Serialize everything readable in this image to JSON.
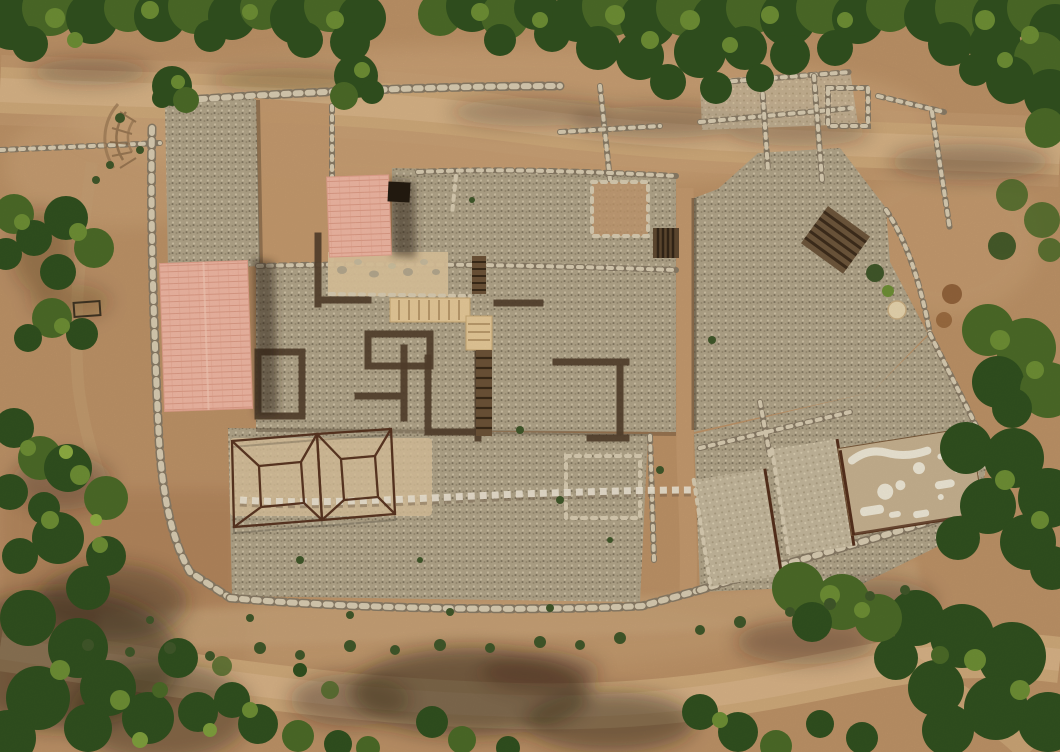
{
  "meta": {
    "title": "Aerial view of archaeological excavation site",
    "description": "Vertical aerial photograph of an excavated ancient settlement: gravel-covered platforms with stone wall foundations, two salmon-pink protective tile roofs, a rust-colored metal wireframe reconstruction, wooden walkway, stairways, a white plastered floor area, surrounded by dirt roads, scrub rows and dark green tree canopy."
  },
  "palette": {
    "dirt_base": "#bd9267",
    "dirt_light": "#d7b287",
    "dirt_red": "#a97a50",
    "road": "#cfa97a",
    "road_core": "#dcb98e",
    "gravel": "#b2a58a",
    "gravel_light": "#c4b79c",
    "sand": "#dcc49c",
    "stone_light": "#d9cdb2",
    "stone_dark": "#8a7c66",
    "trench": "#54402c",
    "rust": "#55301c",
    "wood": "#e6c998",
    "wood_line": "#ad8d5f",
    "roof_pink": "#f0b7a3",
    "roof_tile": "#de9c86",
    "tree_shade": "#22391a",
    "tree_dark": "#31511f",
    "tree_mid": "#4c6b28",
    "tree_light": "#6e8f35",
    "bush": "#41582a",
    "shadow": "#2e2114",
    "mosaic_white": "#efe8d6",
    "disc": "#e7d5ae"
  },
  "scene": {
    "type": "aerial-photo",
    "subject": "archaeological excavation",
    "features": [
      {
        "id": "tree-canopy-top",
        "label": "tree canopy band along top edge"
      },
      {
        "id": "dirt-road-top",
        "label": "dirt road below tree line"
      },
      {
        "id": "terrace-walls",
        "label": "rubble stone terrace walls"
      },
      {
        "id": "gravel-platforms",
        "label": "gravel-covered excavation platforms"
      },
      {
        "id": "protective-roof-large",
        "label": "large pink tiled protective roof"
      },
      {
        "id": "protective-roof-small",
        "label": "small pink tiled protective roof"
      },
      {
        "id": "metal-frame",
        "label": "rust metal wireframe building reconstruction"
      },
      {
        "id": "wooden-walkway",
        "label": "wooden visitor walkway"
      },
      {
        "id": "stairways",
        "label": "stone and wood stairways"
      },
      {
        "id": "mosaic-floor",
        "label": "white plastered floor remains"
      },
      {
        "id": "column-base-disc",
        "label": "round stone disc"
      },
      {
        "id": "bottom-path",
        "label": "curving dirt footpath"
      },
      {
        "id": "vegetation",
        "label": "shrub rows and trees with cast shadows"
      }
    ]
  }
}
